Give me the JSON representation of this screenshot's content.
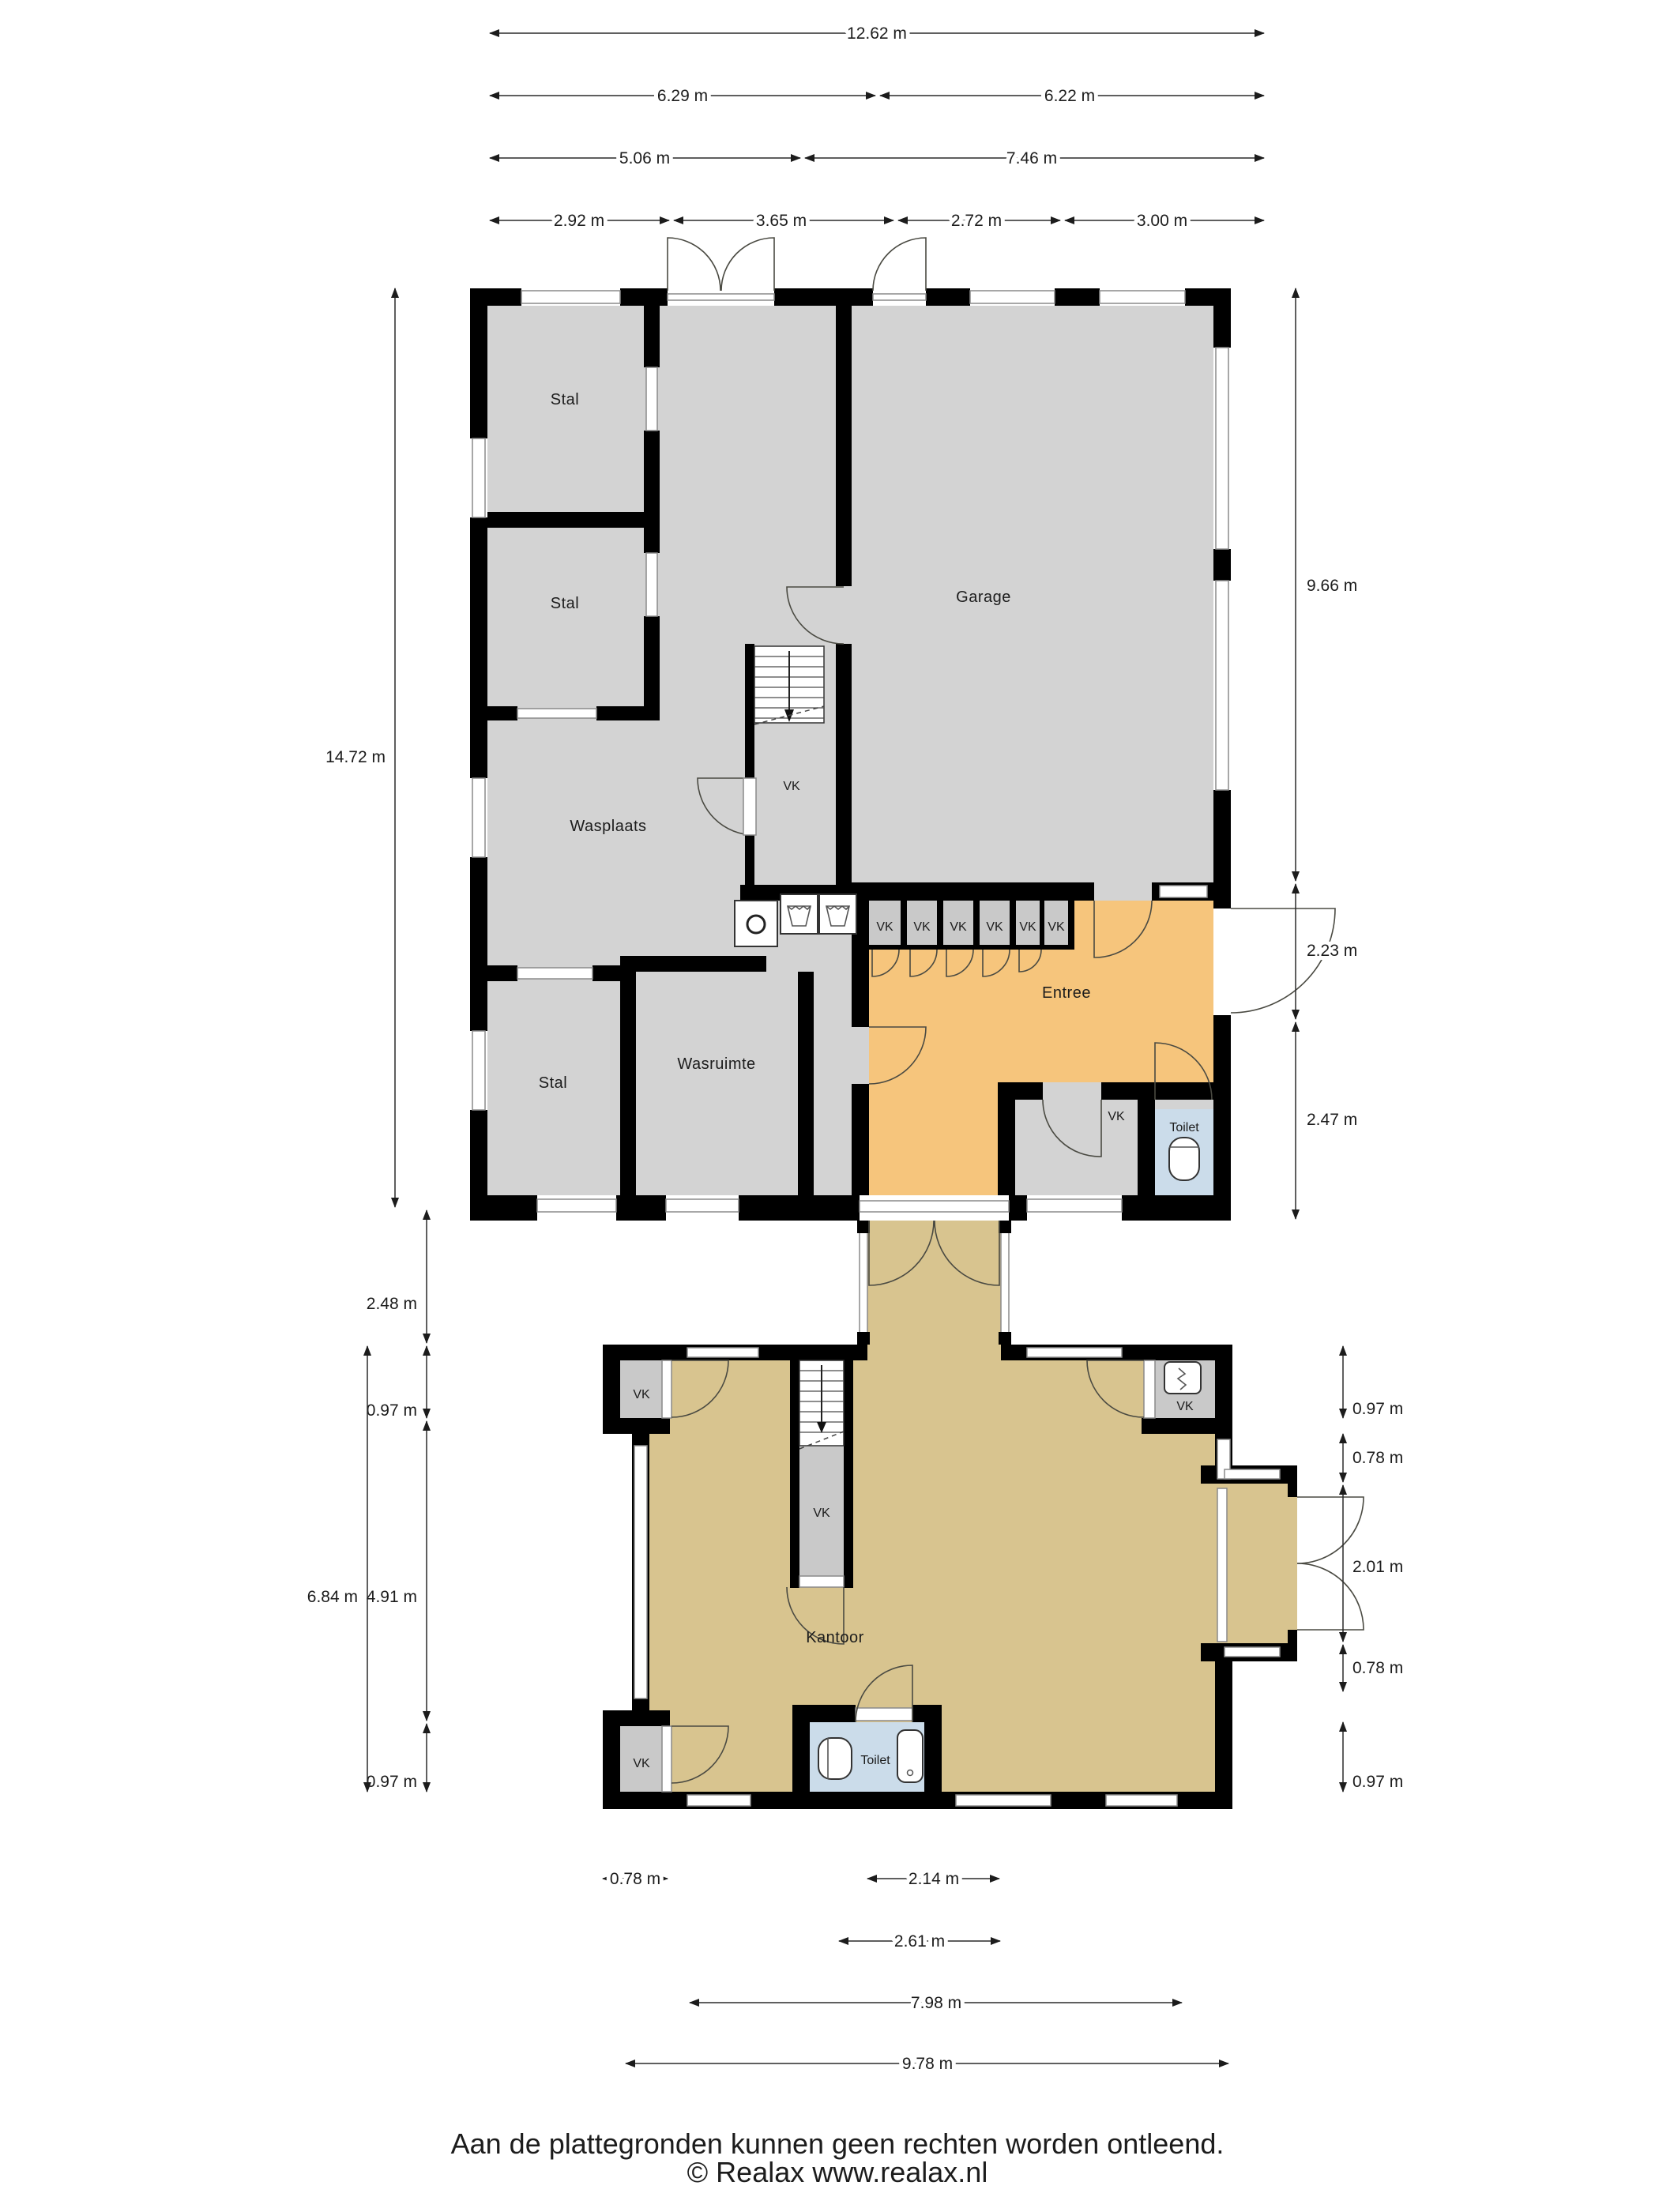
{
  "document": {
    "type": "floor-plan",
    "language": "nl"
  },
  "labels": {
    "stal": "Stal",
    "garage": "Garage",
    "wasplaats": "Wasplaats",
    "wasruimte": "Wasruimte",
    "entree": "Entree",
    "toilet": "Toilet",
    "kantoor": "Kantoor",
    "vk": "VK"
  },
  "dimensions": {
    "top": [
      "12.62 m",
      "6.29 m",
      "6.22 m",
      "5.06 m",
      "7.46 m",
      "2.92 m",
      "3.65 m",
      "2.72 m",
      "3.00 m"
    ],
    "left": [
      "14.72 m",
      "2.48 m",
      "0.97 m",
      "4.91 m",
      "0.97 m",
      "6.84 m"
    ],
    "right": [
      "9.66 m",
      "2.23 m",
      "2.47 m",
      "0.97 m",
      "0.78 m",
      "2.01 m",
      "0.78 m",
      "0.97 m"
    ],
    "bottom": [
      "0.78 m",
      "2.14 m",
      "2.61 m",
      "7.98 m",
      "9.78 m"
    ]
  },
  "footer": {
    "disclaimer": "Aan de plattegronden kunnen geen rechten worden ontleend.",
    "copyright": "© Realax www.realax.nl"
  },
  "colors": {
    "wall": "#000000",
    "room_gray": "#d3d3d3",
    "entree_orange": "#f6c57c",
    "office_tan": "#d8c48f",
    "toilet_blue": "#cbdcea",
    "closet_gray": "#c9c9c9"
  }
}
